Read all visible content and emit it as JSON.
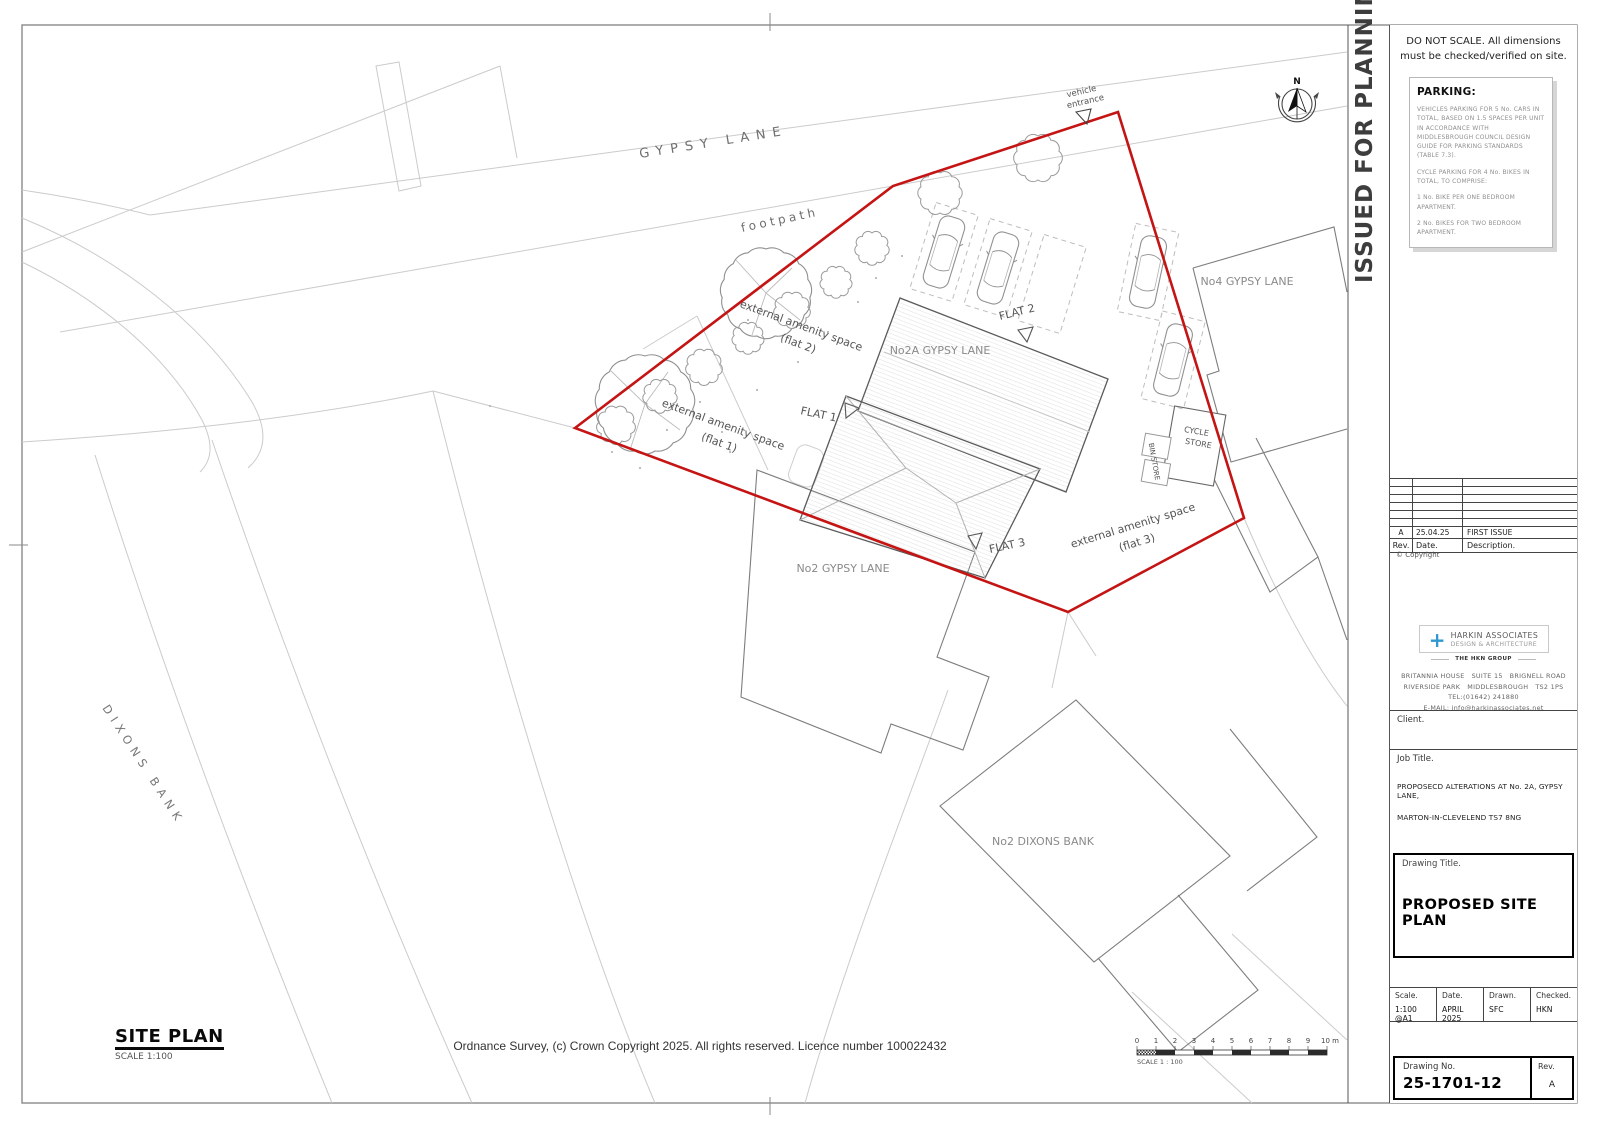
{
  "colors": {
    "boundary_red": "#c41414",
    "logo_blue": "#2f98d0",
    "hatch_gray": "#d9d9d9"
  },
  "sheet": {
    "issued_banner": "ISSUED FOR PLANNING",
    "do_not_scale_note": "DO NOT SCALE. All dimensions must be checked/verified on site."
  },
  "parking_note": {
    "title": "PARKING:",
    "para1": "VEHICLES PARKING FOR 5 No. CARS IN TOTAL, BASED ON 1.5 SPACES PER UNIT IN ACCORDANCE WITH MIDDLESBROUGH COUNCIL DESIGN GUIDE FOR PARKING STANDARDS (TABLE 7.3).",
    "para2": "CYCLE PARKING FOR 4 No. BIKES IN TOTAL, TO COMPRISE:",
    "para3": "1 No. BIKE PER ONE BEDROOM APARTMENT.",
    "para4": "2 No. BIKES FOR TWO BEDROOM APARTMENT."
  },
  "revision_table": {
    "rev_header": "Rev.",
    "date_header": "Date.",
    "desc_header": "Description.",
    "rows": [
      {
        "rev": "A",
        "date": "25.04.25",
        "desc": "FIRST ISSUE"
      }
    ],
    "copyright": "© Copyright"
  },
  "firm": {
    "plus": "+",
    "name": "HARKIN ASSOCIATES",
    "tagline": "DESIGN & ARCHITECTURE",
    "group": "THE HKN GROUP",
    "address1": "BRITANNIA HOUSE   SUITE 15   BRIGNELL ROAD",
    "address2": "RIVERSIDE PARK   MIDDLESBROUGH   TS2 1PS",
    "tel": "TEL:(01642) 241880",
    "email": "E-MAIL: info@harkinassociates.net"
  },
  "titleblock": {
    "client_label": "Client.",
    "job_title_label": "Job Title.",
    "job_line1": "PROPOSECD ALTERATIONS AT No. 2A, GYPSY LANE,",
    "job_line2": "MARTON-IN-CLEVELEND TS7 8NG",
    "drawing_title_label": "Drawing Title.",
    "drawing_title": "PROPOSED SITE PLAN",
    "scale_label": "Scale.",
    "scale_value": "1:100 @A1",
    "date_label": "Date.",
    "date_value": "APRIL 2025",
    "drawn_label": "Drawn.",
    "drawn_value": "SFC",
    "checked_label": "Checked.",
    "checked_value": "HKN",
    "drawing_no_label": "Drawing No.",
    "drawing_no": "25-1701-12",
    "rev_label": "Rev.",
    "rev_value": "A"
  },
  "plan": {
    "labels": {
      "road": "GYPSY LANE",
      "footpath": "footpath",
      "vehicle_line1": "vehicle",
      "vehicle_line2": "entrance",
      "amenity": "external amenity space",
      "flat1_sub": "(flat 1)",
      "flat2_sub": "(flat 2)",
      "flat3_sub": "(flat 3)",
      "flat1": "FLAT 1",
      "flat2": "FLAT 2",
      "flat3": "FLAT 3",
      "no2a": "No2A GYPSY LANE",
      "no2": "No2 GYPSY LANE",
      "no4": "No4 GYPSY LANE",
      "no2_dixons": "No2 DIXONS BANK",
      "dixons_bank": "DIXONS BANK",
      "cycle1": "CYCLE",
      "cycle2": "STORE",
      "bin_store": "BIN STORE",
      "north": "N"
    }
  },
  "footer": {
    "site_plan_title": "SITE PLAN",
    "site_plan_scale": "SCALE 1:100",
    "os_copyright": "Ordnance Survey, (c) Crown Copyright 2025. All rights reserved. Licence number 100022432",
    "scalebar_label": "SCALE 1 : 100",
    "scalebar_ticks": [
      "0",
      "1",
      "2",
      "3",
      "4",
      "5",
      "6",
      "7",
      "8",
      "9",
      "10 m"
    ]
  }
}
